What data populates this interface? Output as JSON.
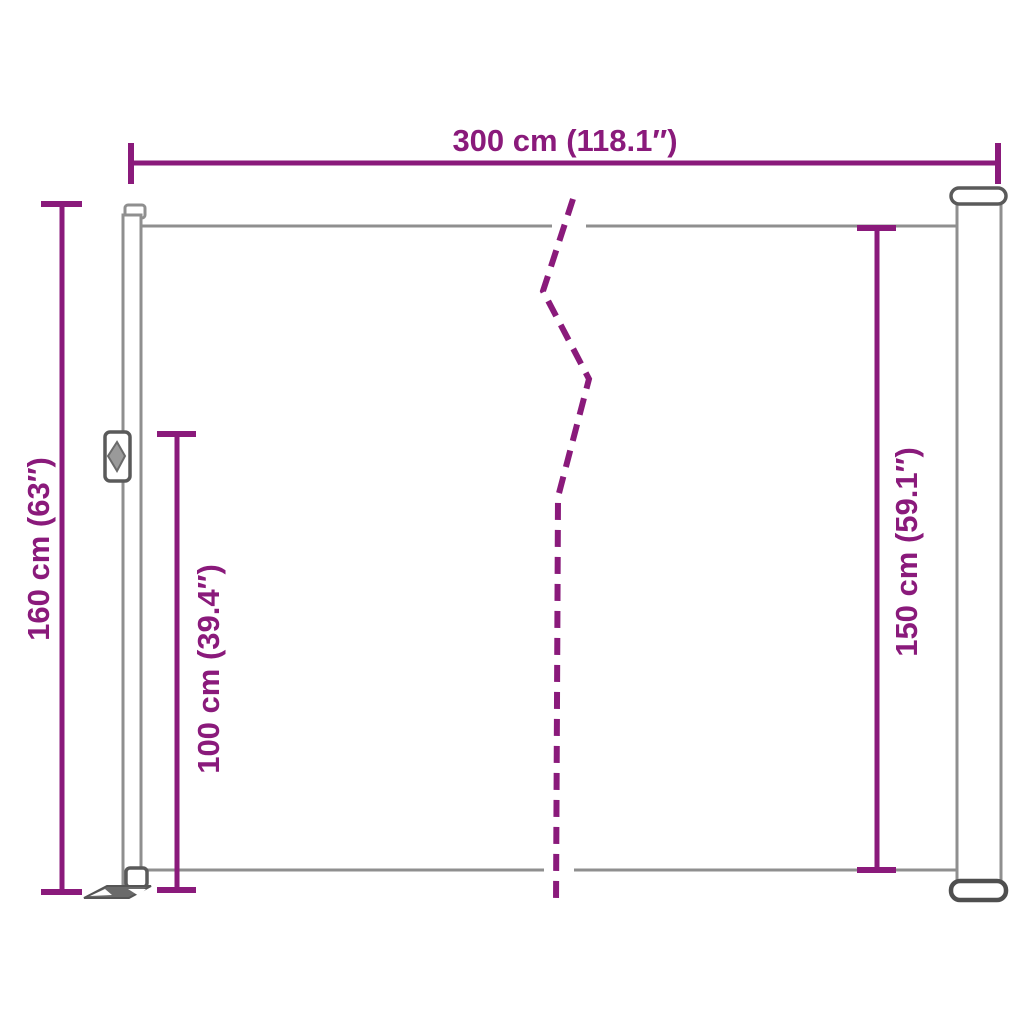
{
  "diagram": {
    "dimensions": {
      "width_total": {
        "label": "300 cm (118.1″)"
      },
      "height_total": {
        "label": "160 cm (63″)"
      },
      "height_pole": {
        "label": "100 cm (39.4″)"
      },
      "height_fabric": {
        "label": "150 cm (59.1″)"
      }
    },
    "colors": {
      "dimension_accent": "#8a1a7b",
      "outline_gray": "#8f8f8f",
      "outline_dark_gray": "#5a5a5a",
      "background": "#ffffff"
    }
  }
}
